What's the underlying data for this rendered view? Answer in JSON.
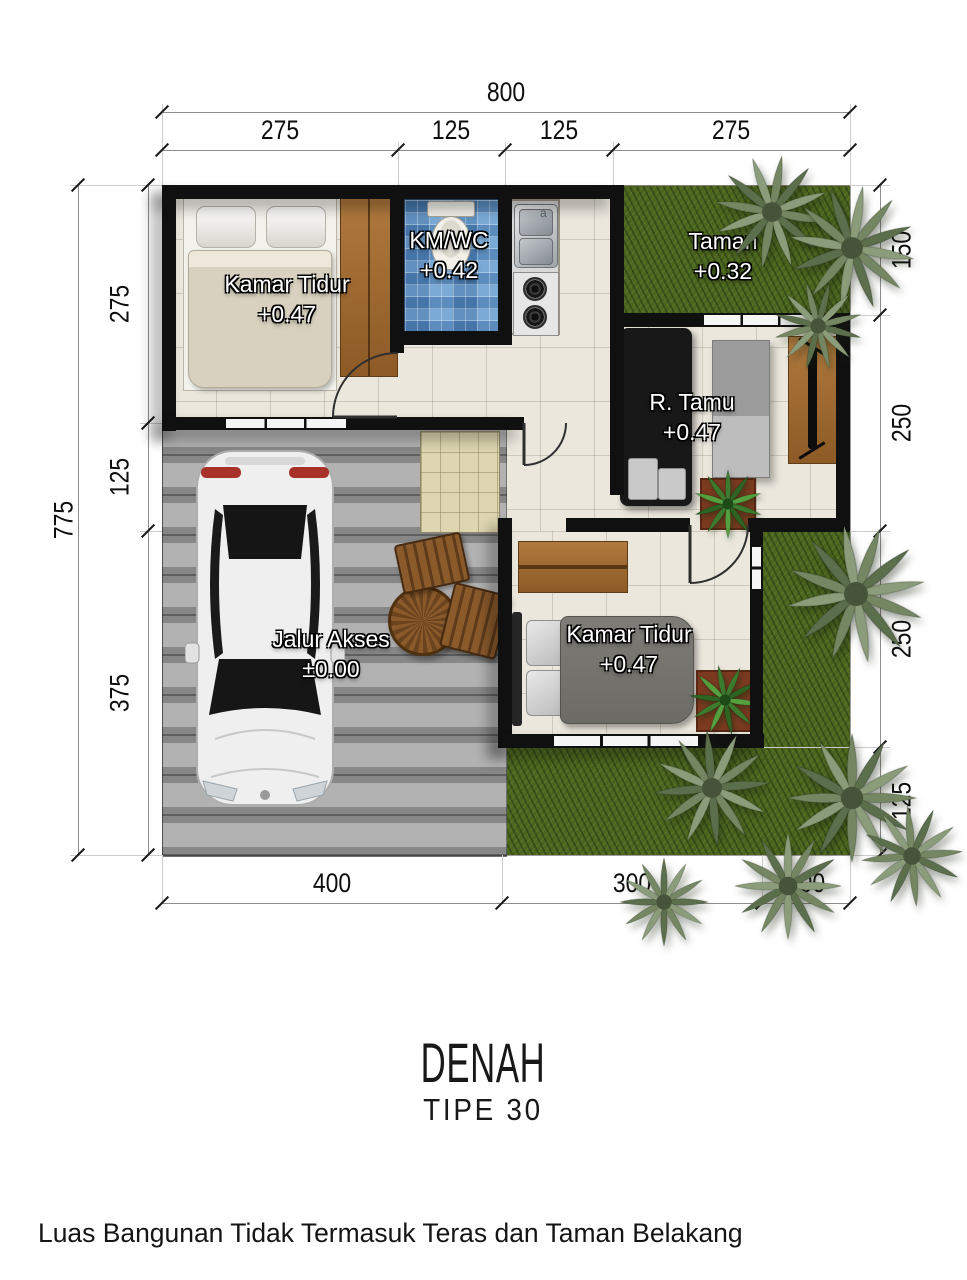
{
  "title": {
    "main": "DENAH",
    "subtitle": "TIPE 30"
  },
  "footer": {
    "note": "Luas Bangunan Tidak Termasuk Teras dan Taman Belakang"
  },
  "dimensions": {
    "top": {
      "total": "800",
      "segments": [
        "275",
        "125",
        "125",
        "275"
      ]
    },
    "left": {
      "total": "775",
      "segments": [
        "275",
        "125",
        "375"
      ]
    },
    "right": {
      "segments": [
        "150",
        "250",
        "250",
        "125"
      ]
    },
    "bottom": {
      "segments": [
        "400",
        "300",
        "100"
      ]
    }
  },
  "rooms": {
    "bedroom1": {
      "name": "Kamar Tidur",
      "level": "+0.47"
    },
    "bathroom": {
      "name": "KM/WC",
      "level": "+0.42"
    },
    "garden": {
      "name": "Taman",
      "level": "+0.32"
    },
    "living": {
      "name": "R. Tamu",
      "level": "+0.47"
    },
    "bedroom2": {
      "name": "Kamar Tidur",
      "level": "+0.47"
    },
    "driveway": {
      "name": "Jalur Akses",
      "level": "±0.00"
    }
  },
  "kitchen": {
    "sink_mark": "a"
  },
  "colors": {
    "wall": "#101010",
    "floor": "#EBE7DD",
    "blue_tile": "#5D95C8",
    "grass": "#4B661F",
    "paving": "#9F9F9F",
    "terrace": "#DDD6B0",
    "wood": "#A06A33"
  }
}
